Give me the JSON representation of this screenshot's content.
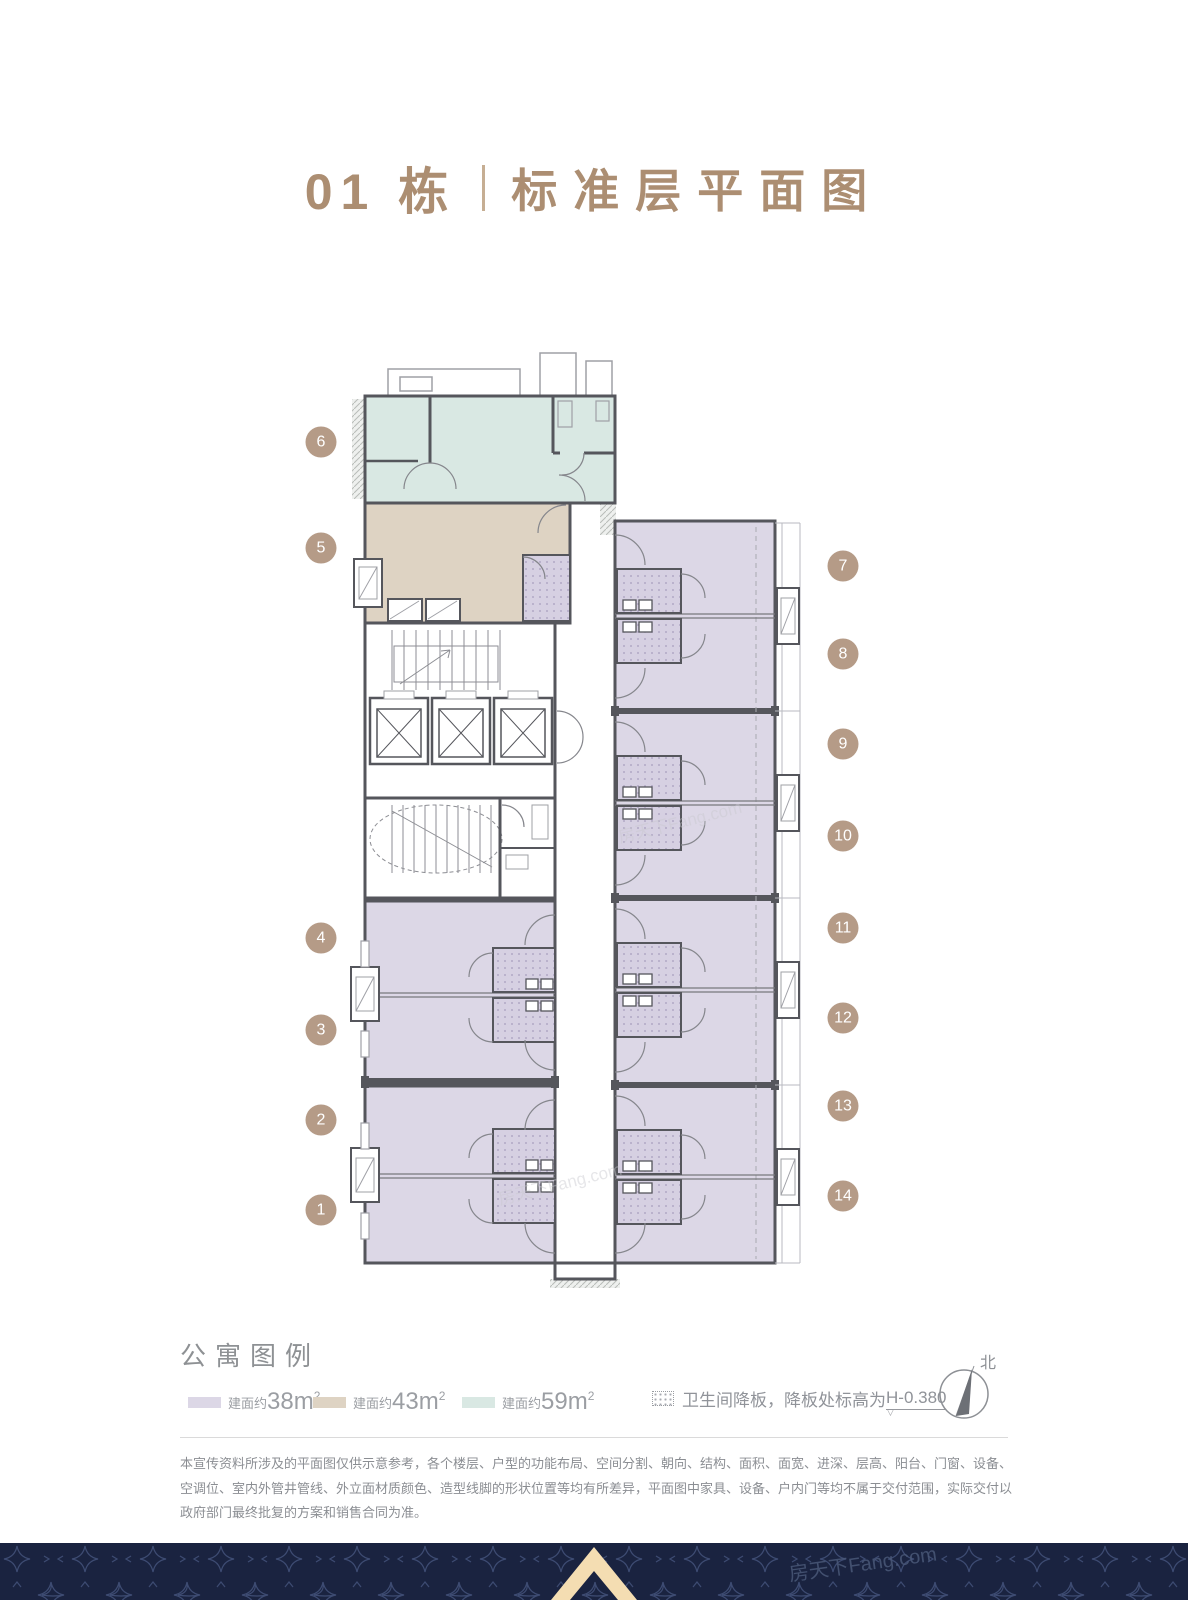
{
  "title": {
    "building": "01 栋",
    "name": "标准层平面图"
  },
  "plan": {
    "units": [
      "1",
      "2",
      "3",
      "4",
      "5",
      "6",
      "7",
      "8",
      "9",
      "10",
      "11",
      "12",
      "13",
      "14"
    ]
  },
  "legend": {
    "title": "公寓图例",
    "items": [
      {
        "prefix": "建面约",
        "value": "38",
        "unit": "m",
        "sup": "2",
        "swatch_style": "background:#dcd7e6"
      },
      {
        "prefix": "建面约",
        "value": "43",
        "unit": "m",
        "sup": "2",
        "swatch_style": "background:#ded3c3"
      },
      {
        "prefix": "建面约",
        "value": "59",
        "unit": "m",
        "sup": "2",
        "swatch_style": "background:#d9e8e3"
      }
    ],
    "note": {
      "text": "卫生间降板，降板处标高为",
      "value": "H-0.380",
      "marker": "▽"
    },
    "compass": {
      "label": "北"
    }
  },
  "disclaimer": "本宣传资料所涉及的平面图仅供示意参考，各个楼层、户型的功能布局、空间分割、朝向、结构、面积、面宽、进深、层高、阳台、门窗、设备、空调位、室内外管井管线、外立面材质颜色、造型线脚的形状位置等均有所差异，平面图中家具、设备、户内门等均不属于交付范围，实际交付以政府部门最终批复的方案和销售合同为准。",
  "watermark": "房天下Fang.com",
  "colors": {
    "accent": "#ac8e72",
    "badge": "#b59b87",
    "wall": "#55565c",
    "area_38": "#dcd7e6",
    "area_43": "#ded3c3",
    "area_59": "#d9e8e3",
    "footer_bg": "#1a2340",
    "footer_pattern": "#3d4b72",
    "footer_logo": "#f4ddb2"
  }
}
